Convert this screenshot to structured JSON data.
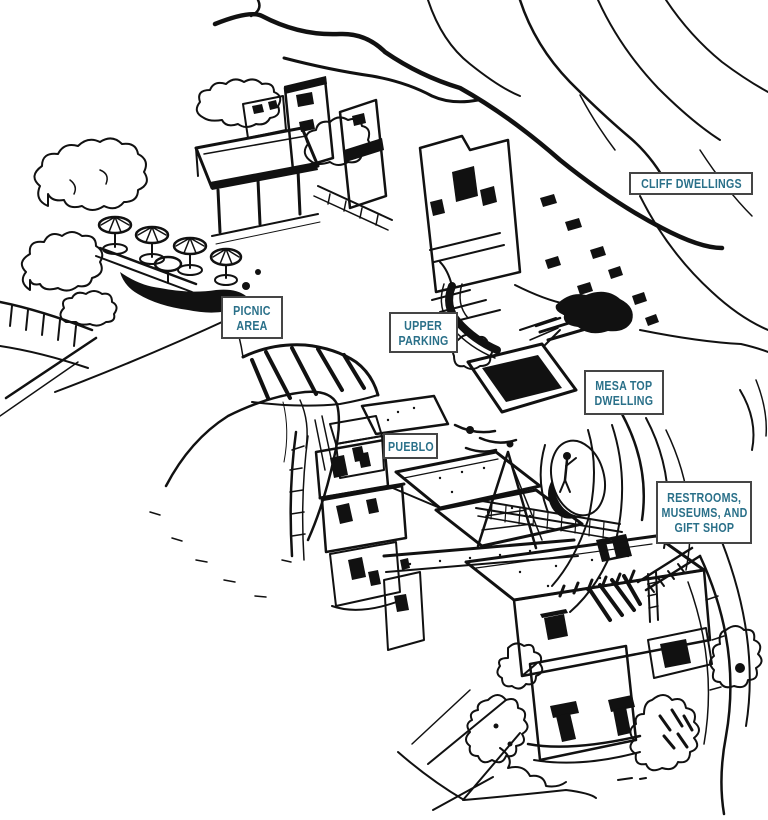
{
  "map": {
    "background_color": "#ffffff",
    "ink_color": "#111111",
    "label_style": {
      "text_color": "#2a7089",
      "border_color": "#454545",
      "bg_color": "#ffffff"
    },
    "labels": {
      "cliff_dwellings": {
        "lines": [
          "CLIFF DWELLINGS"
        ]
      },
      "picnic_area": {
        "lines": [
          "PICNIC",
          "AREA"
        ]
      },
      "upper_parking": {
        "lines": [
          "UPPER",
          "PARKING"
        ]
      },
      "mesa_top_dwelling": {
        "lines": [
          "MESA TOP",
          "DWELLING"
        ]
      },
      "pueblo": {
        "lines": [
          "PUEBLO"
        ]
      },
      "restrooms_museums_gift_shop": {
        "lines": [
          "RESTROOMS,",
          "MUSEUMS, AND",
          "GIFT SHOP"
        ]
      }
    }
  }
}
